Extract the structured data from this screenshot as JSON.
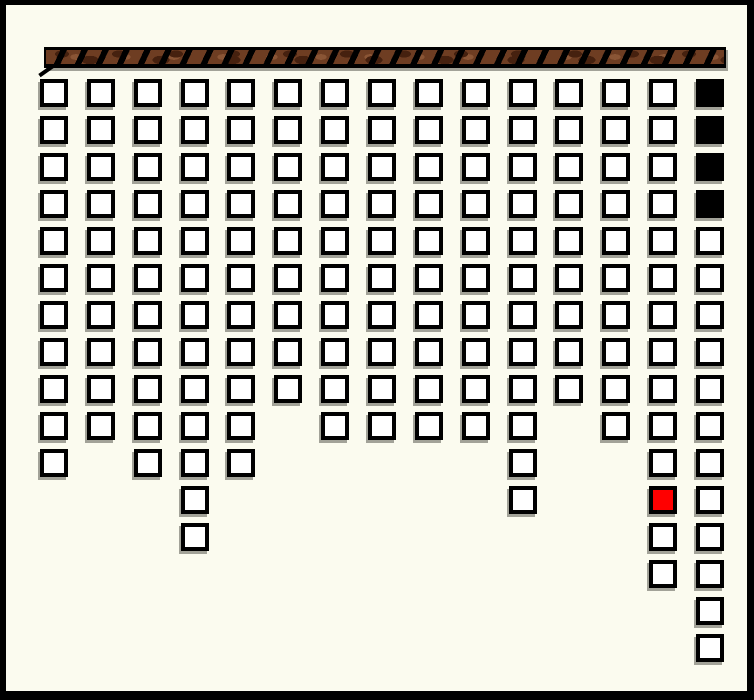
{
  "app": {
    "name": "hanging-blocks-game-board",
    "description": "game board of outlined square blocks hanging in columns from a textured beam"
  },
  "palette": {
    "background": "#fbfbef",
    "frame": "#000000",
    "cell_fill": "#ffffff",
    "cell_border": "#000000",
    "black_cell": "#000000",
    "red_cell": "#ff0000",
    "shadow": "#a2a298",
    "bar_black": "#000000",
    "bar_brown": "#6e3d22",
    "bar_brown_dark": "#46210f",
    "bar_brown_light": "#8a5535"
  },
  "top_bar": {
    "x": 38,
    "y": 42,
    "width": 682,
    "height": 21,
    "texture": "brown-diagonal-rope-stripes"
  },
  "board": {
    "columns": 15,
    "max_rows": 16,
    "origin_x": 34,
    "origin_y": 74,
    "col_pitch": 46.857,
    "row_pitch": 37,
    "cell_size": 28,
    "stack_heights": [
      11,
      10,
      11,
      13,
      11,
      9,
      10,
      10,
      10,
      10,
      12,
      9,
      10,
      14,
      16
    ],
    "black_cells": [
      {
        "col": 15,
        "row": 1
      },
      {
        "col": 15,
        "row": 2
      },
      {
        "col": 15,
        "row": 3
      },
      {
        "col": 15,
        "row": 4
      }
    ],
    "red_cells": [
      {
        "col": 14,
        "row": 12
      }
    ],
    "total_cells": 166
  }
}
